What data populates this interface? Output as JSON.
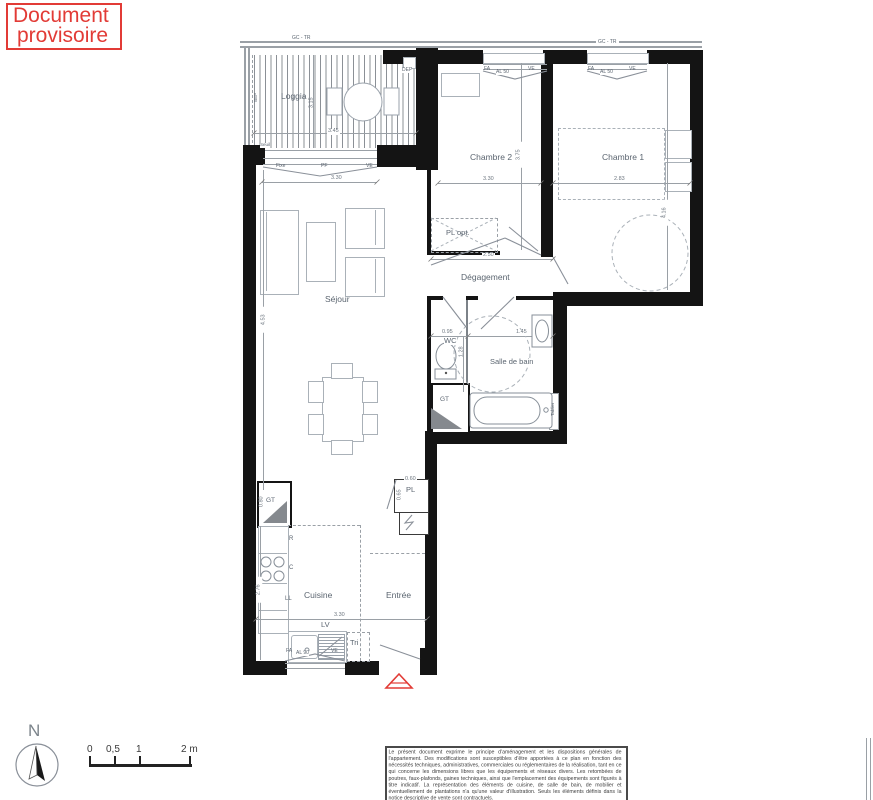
{
  "stamp": {
    "line1": "Document",
    "line2": "provisoire"
  },
  "rooms": {
    "loggia": "Loggia",
    "chambre2": "Chambre 2",
    "chambre1": "Chambre 1",
    "sejour": "Séjour",
    "degagement": "Dégagement",
    "wc": "WC",
    "salle_de_bain": "Salle de bain",
    "cuisine": "Cuisine",
    "entree": "Entrée"
  },
  "fixtures": {
    "pl_opt": "PL opt.",
    "pl": "PL",
    "gt": "GT",
    "lv": "LV",
    "tri": "Tri",
    "refrigerateur": "R",
    "cuisson": "C",
    "lave_linge": "LL",
    "dep": "DEP",
    "seuil": "Seuil",
    "bep": "BEP",
    "tablier": "Tablier",
    "garde_corps": "GC - TR"
  },
  "window_labels": {
    "fixe": "Fixe",
    "pf": "PF",
    "ve": "VE",
    "fa": "FA",
    "al50": "AL 50",
    "al90": "AL 90"
  },
  "dimensions": {
    "loggia_w": "3.45",
    "loggia_h": "3.15",
    "sejour_window": "3.30",
    "sejour_h": "4.53",
    "chambre2_w": "3.30",
    "chambre2_h": "3.75",
    "chambre1_w": "2.83",
    "chambre1_h": "4.16",
    "degagement_w": "2.50",
    "wc_w": "0.95",
    "wc_h": "1.28",
    "sdb_w": "1.45",
    "cuisine_w": "3.30",
    "cuisine_h": "2.76",
    "gt_h": "0.80",
    "pl_w": "0.60",
    "pl_h": "0.65"
  },
  "compass": {
    "north": "N"
  },
  "scale_bar": {
    "tick0": "0",
    "tick05": "0,5",
    "tick1": "1",
    "tick2": "2 m"
  },
  "disclaimer": "Le présent document exprime le principe d'aménagement et les dispositions générales de l'appartement. Des modifications sont susceptibles d'être apportées à ce plan en fonction des nécessités techniques, administratives, commerciales ou réglementaires de la réalisation, tant en ce qui concerne les dimensions libres que les équipements et réseaux divers. Les retombées de poutres, faux-plafonds, gaines techniques, ainsi que l'emplacement des équipements sont figurés à titre indicatif. La représentation des éléments de cuisine, de salle de bain, de mobilier et éventuellement de plantations n'a qu'une valeur d'illustration. Seuls les éléments définis dans la notice descriptive de vente sont contractuels.",
  "colors": {
    "stamp_red": "#e23b36",
    "arrow_red": "#e23b36",
    "wall_black": "#141414",
    "label_gray": "#5b6570",
    "dim_gray": "#6e7780"
  }
}
